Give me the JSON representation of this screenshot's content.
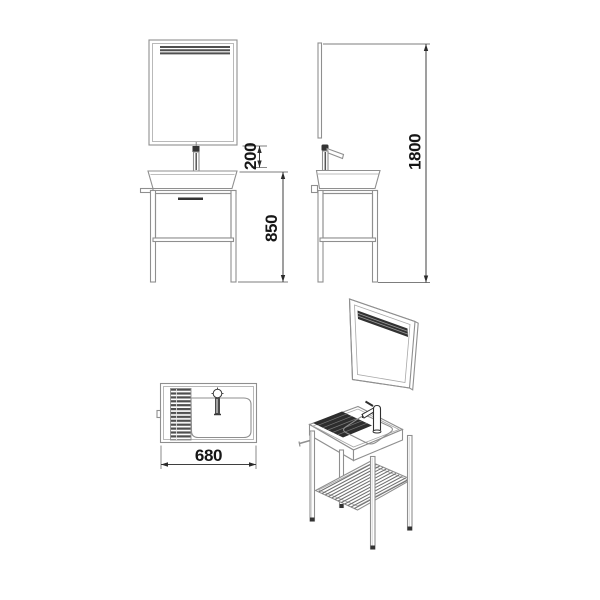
{
  "dimensions": {
    "mirror_to_basin_gap": "200",
    "vanity_height": "850",
    "overall_height": "1800",
    "vanity_width": "680"
  },
  "colors": {
    "background": "#ffffff",
    "outline": "#8f8f8f",
    "dark_fill": "#2f2f2f",
    "dimension_line": "#3f3f3f",
    "dimension_text": "#161616"
  }
}
